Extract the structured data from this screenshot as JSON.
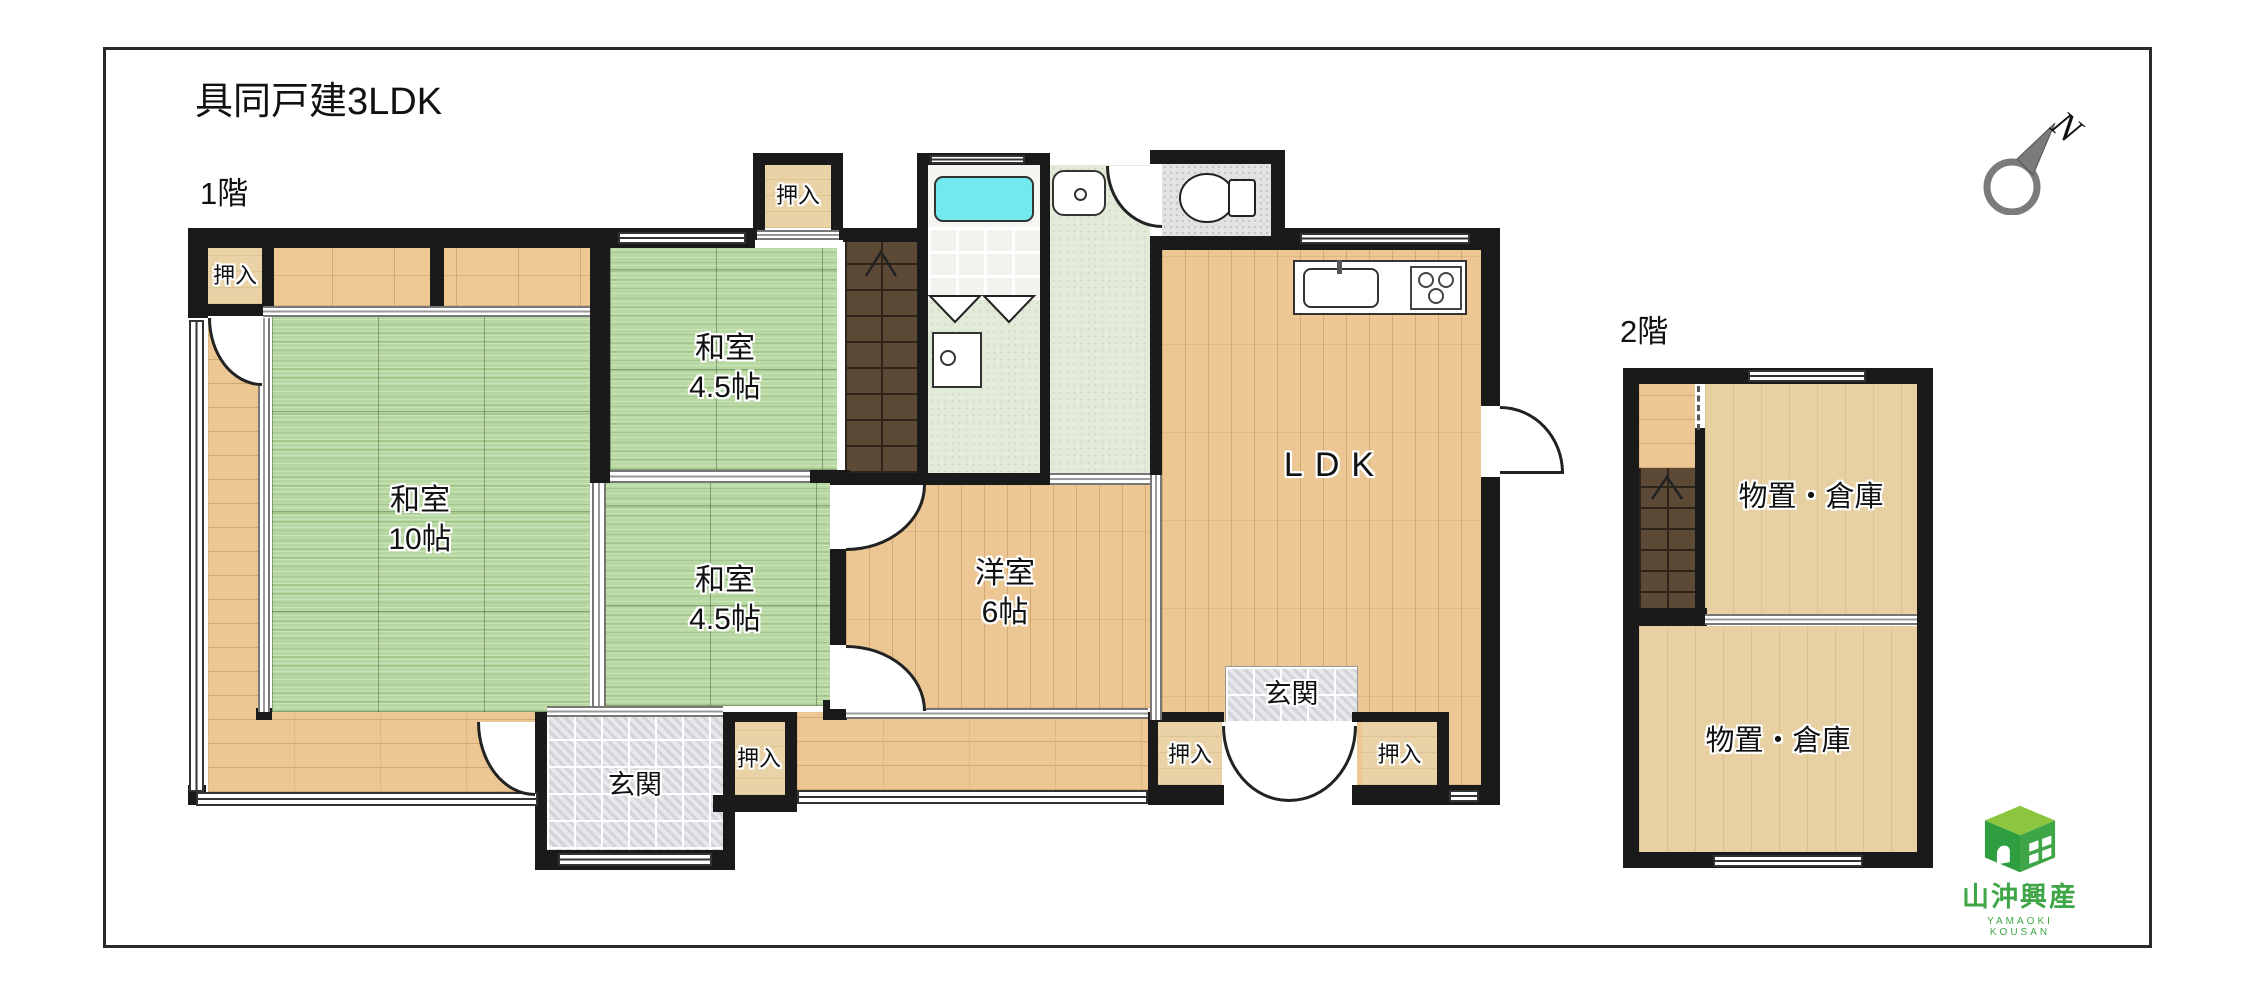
{
  "header": {
    "title": "具同戸建3LDK"
  },
  "floors": {
    "f1": "1階",
    "f2": "2階"
  },
  "compass": {
    "north": "N"
  },
  "rooms": {
    "washitsu_10": {
      "name": "和室",
      "size": "10帖"
    },
    "washitsu_45_north": {
      "name": "和室",
      "size": "4.5帖"
    },
    "washitsu_45_center": {
      "name": "和室",
      "size": "4.5帖"
    },
    "yoshitsu_6": {
      "name": "洋室",
      "size": "6帖"
    },
    "ldk": {
      "name": "LDK"
    },
    "genkan": {
      "name": "玄関"
    },
    "oshiire": {
      "name": "押入"
    },
    "storage": {
      "name": "物置・倉庫"
    }
  },
  "logo": {
    "company": "山沖興産",
    "romaji": "YAMAOKI KOUSAN"
  },
  "colors": {
    "tatami": "#b7d8a0",
    "wood": "#ecc794",
    "closet": "#e9d2a6",
    "stairs": "#5c4936",
    "bathtub": "#72e9ef",
    "genkan_tile": "#e7e7ec",
    "wall": "#1a1a1a",
    "logo_green": "#3fa648"
  }
}
